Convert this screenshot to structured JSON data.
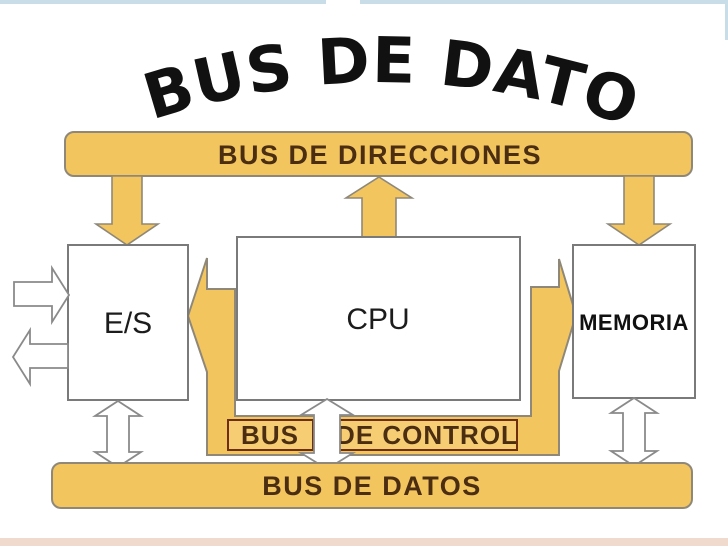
{
  "title": {
    "text": "BUS DE DATOS"
  },
  "address_bus": {
    "label": "BUS DE DIRECCIONES"
  },
  "control_bus": {
    "label_left": "BUS",
    "label_right": "DE CONTROL"
  },
  "data_bus": {
    "label": "BUS DE DATOS"
  },
  "components": {
    "io": {
      "label": "E/S"
    },
    "cpu": {
      "label": "CPU"
    },
    "memory": {
      "label": "MEMORIA"
    }
  },
  "colors": {
    "bus_fill": "#F3C55F",
    "bus_fill_light": "#F6CD72",
    "bus_border": "#8F8878",
    "label_text": "#4B2D12",
    "control_label_border": "#6E2F10",
    "box_border": "#7A7A7A",
    "title_text": "#111111",
    "top_line": "#C9DDE9",
    "bottom_strip": "#F0D9CD",
    "arrow_outline": "#8A8A8A"
  }
}
